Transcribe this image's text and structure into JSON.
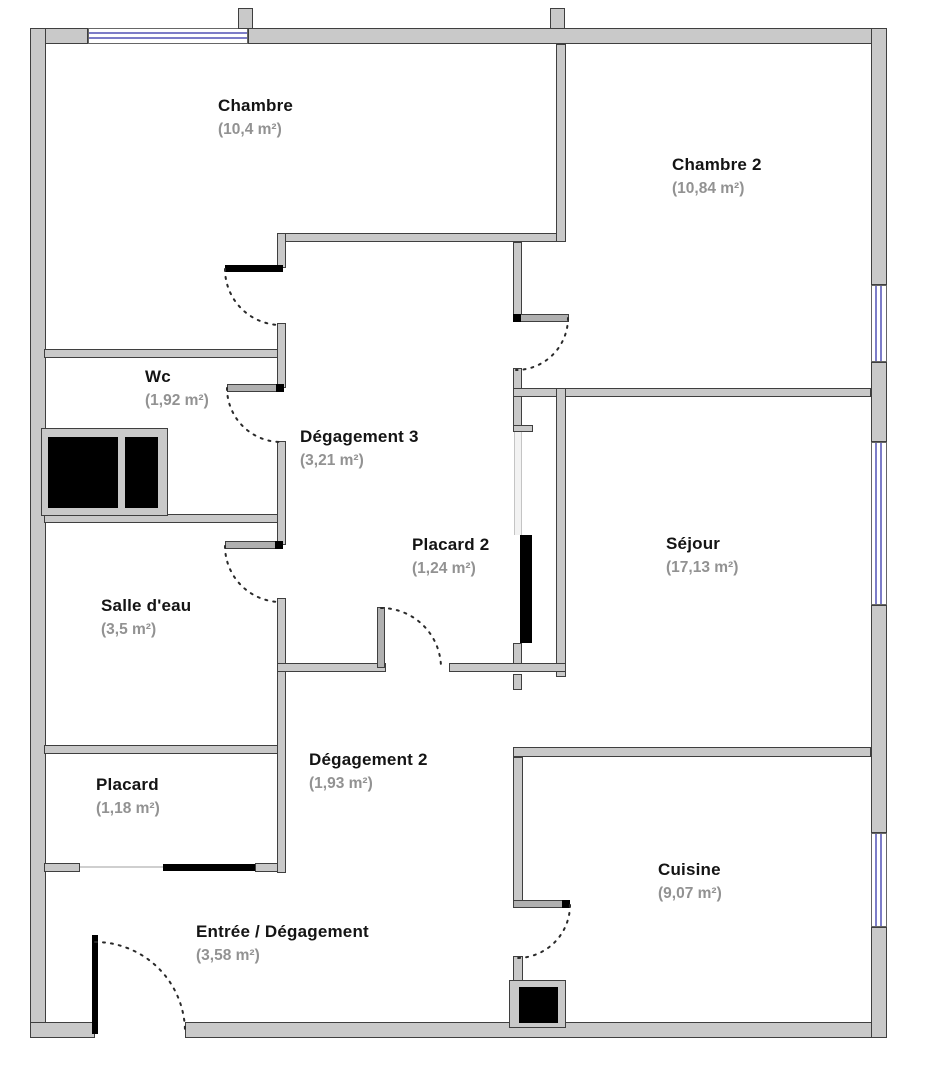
{
  "plan": {
    "title": "Floor plan",
    "colors": {
      "wall-fill": "#c9c9c9",
      "wall-outline": "#3f3f3f",
      "window": "#7d7dc8",
      "fixture": "#000000",
      "room-name": "#141414",
      "room-area": "#929292",
      "background": "#ffffff"
    },
    "rooms": [
      {
        "name": "Chambre",
        "area": "(10,4 m²)"
      },
      {
        "name": "Chambre 2",
        "area": "(10,84 m²)"
      },
      {
        "name": "Wc",
        "area": "(1,92 m²)"
      },
      {
        "name": "Dégagement 3",
        "area": "(3,21 m²)"
      },
      {
        "name": "Placard 2",
        "area": "(1,24 m²)"
      },
      {
        "name": "Séjour",
        "area": "(17,13 m²)"
      },
      {
        "name": "Salle d'eau",
        "area": "(3,5 m²)"
      },
      {
        "name": "Placard",
        "area": "(1,18 m²)"
      },
      {
        "name": "Dégagement 2",
        "area": "(1,93 m²)"
      },
      {
        "name": "Entrée / Dégagement",
        "area": "(3,58 m²)"
      },
      {
        "name": "Cuisine",
        "area": "(9,07 m²)"
      }
    ]
  }
}
